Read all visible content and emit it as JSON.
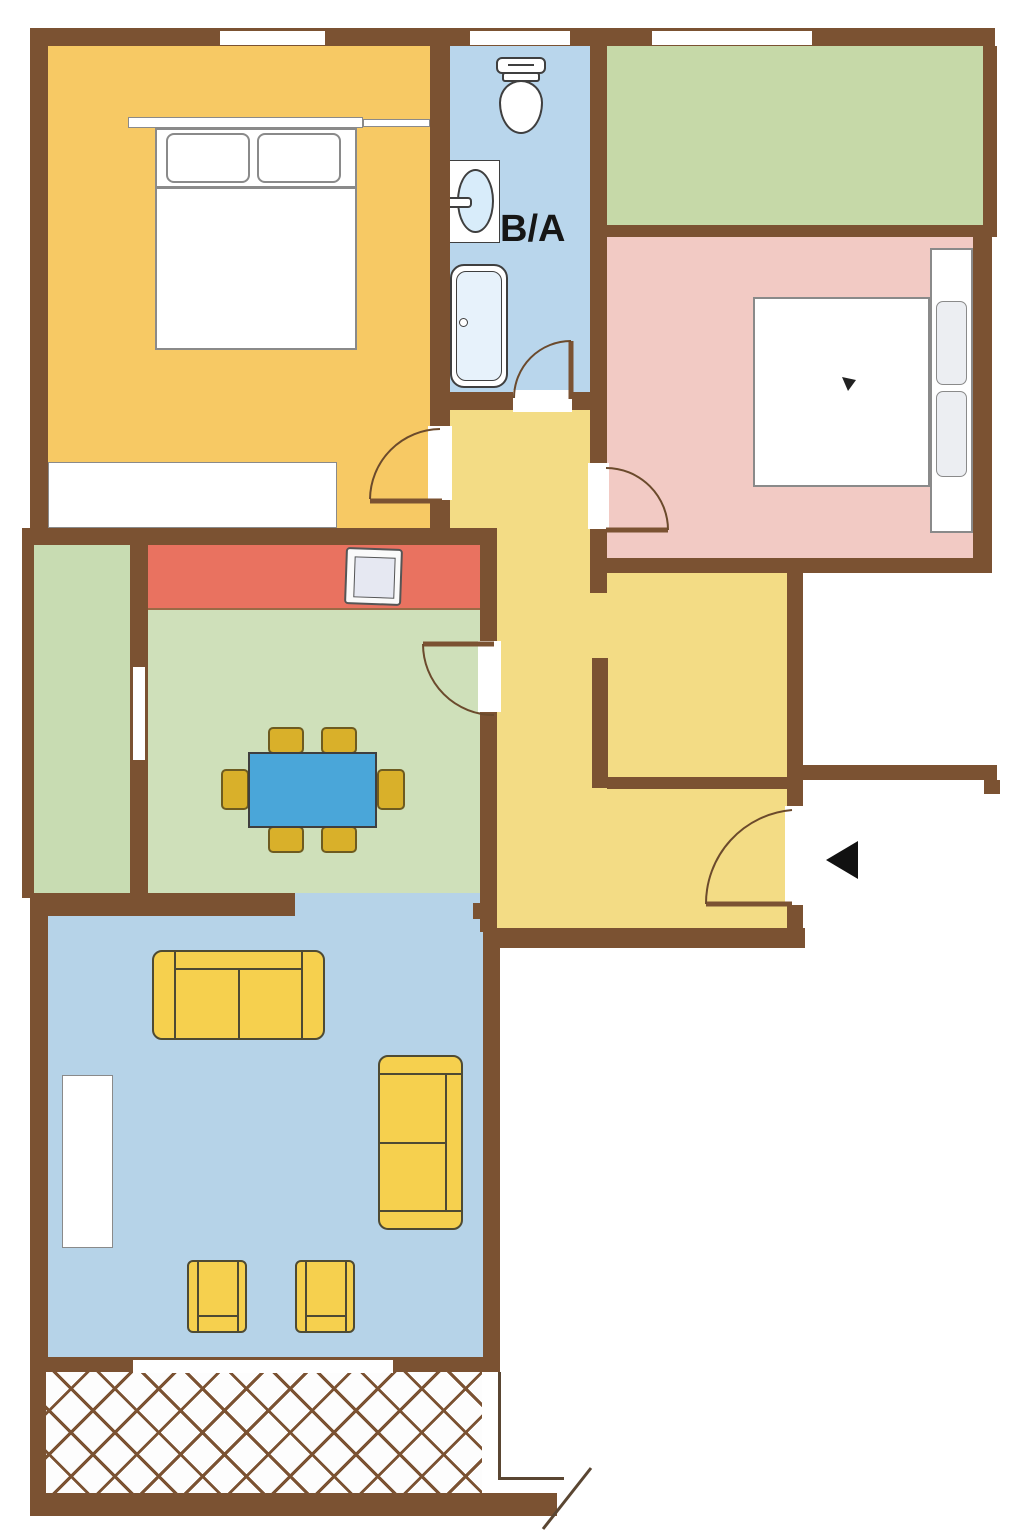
{
  "title": "Apartment floor plan",
  "bathroom": {
    "label": "B/A"
  },
  "colors": {
    "wall": "#7b5232",
    "white": "#ffffff",
    "outline": "#4e4a33",
    "fixture": "#3f3f3f",
    "bed-line": "#8a8a8a",
    "thin-line": "#5a4632",
    "bedroom1": "#f7c964",
    "hallway": "#f3dc85",
    "bathroom": "#b9d6ec",
    "living": "#b6d3e8",
    "dining": "#cfe0ba",
    "loggia": "#c8dcb2",
    "room-tr": "#c6d9a8",
    "bedroom2": "#f2cac4",
    "kitchen": "#e97260",
    "sofa": "#f6d04e",
    "chair": "#d9b02a",
    "chair-border": "#6e5b20",
    "table": "#4aa6d9",
    "basin": "#d8ecfa",
    "tub-inner": "#e7f2fb",
    "pillow": "#eceef2",
    "stove-inner": "#e6e8f2",
    "arrow": "#111111",
    "label": "#161616",
    "hatch-bg": "#fdfdfd"
  },
  "rooms": [
    {
      "id": "bedroom-1",
      "fill": "bedroom1",
      "furniture": [
        "double-bed",
        "wardrobe",
        "shelf"
      ]
    },
    {
      "id": "bathroom",
      "fill": "bathroom",
      "furniture": [
        "toilet",
        "sink",
        "bathtub"
      ]
    },
    {
      "id": "room-top-right",
      "fill": "room-tr",
      "furniture": []
    },
    {
      "id": "bedroom-2",
      "fill": "bedroom2",
      "furniture": [
        "double-bed"
      ]
    },
    {
      "id": "hallway",
      "fill": "hallway",
      "furniture": []
    },
    {
      "id": "kitchen-strip",
      "fill": "kitchen",
      "furniture": [
        "stove"
      ]
    },
    {
      "id": "dining-room",
      "fill": "dining",
      "furniture": [
        "dining-table",
        "six-chairs"
      ]
    },
    {
      "id": "loggia",
      "fill": "loggia",
      "furniture": []
    },
    {
      "id": "living-room",
      "fill": "living",
      "furniture": [
        "sofa",
        "sofa-2",
        "armchair",
        "armchair-2",
        "tv-stand"
      ]
    },
    {
      "id": "balcony",
      "fill": "hatch",
      "furniture": []
    }
  ]
}
